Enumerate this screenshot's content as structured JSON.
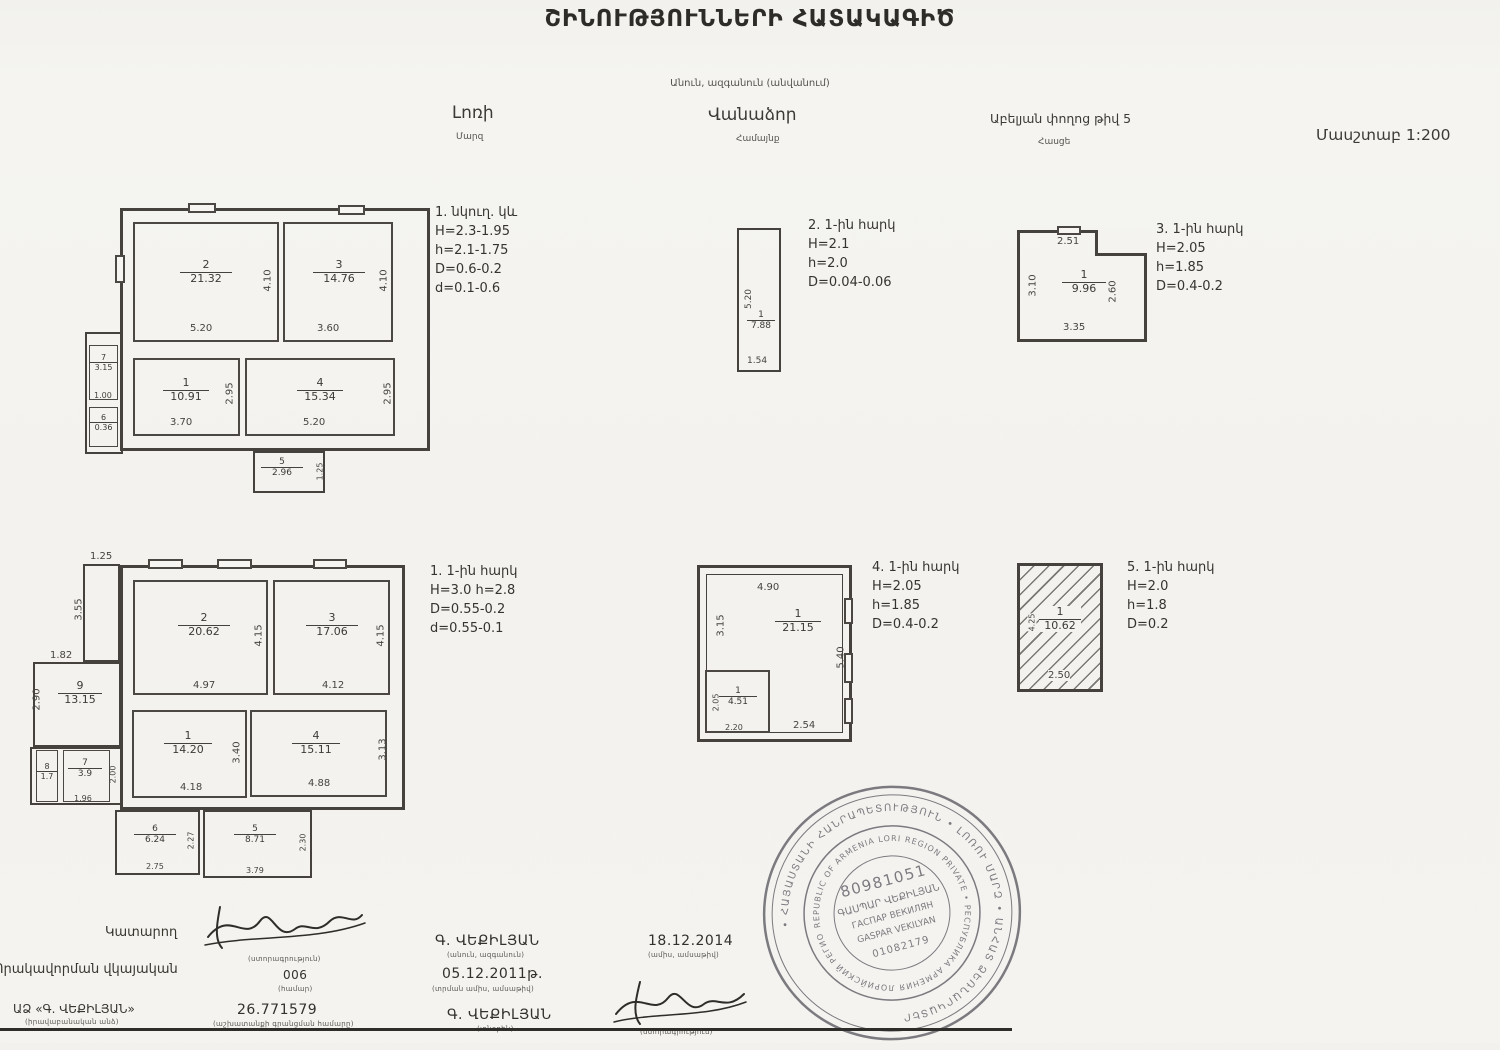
{
  "title": "ՇԻՆՈՒԹՅՈՒՆՆԵՐԻ ՀԱՏԱԿԱԳԻԾ",
  "subtitle": "Անուն, ազգանուն (անվանում)",
  "header": {
    "region_value": "Լոռի",
    "region_label": "Մարզ",
    "community_value": "Վանաձոր",
    "community_label": "Համայնք",
    "address_value": "Աբելյան փողոց թիվ 5",
    "address_label": "Հասցե",
    "scale": "Մասշտաբ 1:200"
  },
  "plans": {
    "basement": {
      "note": [
        "1. նկուղ. կև",
        "H=2.3-1.95",
        "h=2.1-1.75",
        "D=0.6-0.2",
        "d=0.1-0.6"
      ],
      "rooms": {
        "r1": {
          "num": "1",
          "area": "10.91",
          "w": "3.70",
          "h": "2.95"
        },
        "r2": {
          "num": "2",
          "area": "21.32",
          "w": "5.20",
          "h": "4.10"
        },
        "r3": {
          "num": "3",
          "area": "14.76",
          "w": "3.60",
          "h": "4.10"
        },
        "r4": {
          "num": "4",
          "area": "15.34",
          "w": "5.20",
          "h": "2.95"
        },
        "r5": {
          "num": "5",
          "area": "2.96",
          "h": "1.25"
        },
        "r6": {
          "num": "6",
          "area": "0.36"
        },
        "r7": {
          "num": "7",
          "area": "3.15",
          "w": "1.00"
        }
      }
    },
    "wing2": {
      "note": [
        "2. 1-ին հարկ",
        "H=2.1",
        "h=2.0",
        "D=0.04-0.06"
      ],
      "rooms": {
        "r1": {
          "num": "1",
          "area": "7.88",
          "w": "1.54",
          "h": "5.20"
        }
      }
    },
    "wing3": {
      "note": [
        "3. 1-ին հարկ",
        "H=2.05",
        "h=1.85",
        "D=0.4-0.2"
      ],
      "rooms": {
        "r1": {
          "num": "1",
          "area": "9.96",
          "top": "2.51",
          "left": "3.10",
          "right": "2.60",
          "bottom": "3.35"
        }
      }
    },
    "floor1": {
      "note": [
        "1. 1-ին հարկ",
        "H=3.0 h=2.8",
        "D=0.55-0.2",
        "d=0.55-0.1"
      ],
      "dims": {
        "top": "1.25",
        "left": "3.55",
        "annex_top": "1.82",
        "annex_left": "2.90"
      },
      "rooms": {
        "r1": {
          "num": "1",
          "area": "14.20",
          "w": "4.18",
          "h": "3.40"
        },
        "r2": {
          "num": "2",
          "area": "20.62",
          "w": "4.97",
          "h": "4.15"
        },
        "r3": {
          "num": "3",
          "area": "17.06",
          "w": "4.12",
          "h": "4.15"
        },
        "r4": {
          "num": "4",
          "area": "15.11",
          "w": "4.88",
          "h": "3.13"
        },
        "r5": {
          "num": "5",
          "area": "8.71",
          "w": "3.79",
          "h": "2.30"
        },
        "r6": {
          "num": "6",
          "area": "6.24",
          "w": "2.75",
          "h": "2.27"
        },
        "r7": {
          "num": "7",
          "area": "3.9",
          "w": "1.96",
          "h": "2.00"
        },
        "r8": {
          "num": "8",
          "area": "1.7"
        },
        "r9": {
          "num": "9",
          "area": "13.15"
        }
      }
    },
    "wing4": {
      "note": [
        "4. 1-ին հարկ",
        "H=2.05",
        "h=1.85",
        "D=0.4-0.2"
      ],
      "rooms": {
        "r1": {
          "num": "1",
          "area": "21.15",
          "top": "4.90",
          "left": "3.15",
          "right": "5.40",
          "bottom": "2.54"
        },
        "r2": {
          "num": "1",
          "area": "4.51",
          "left": "2.05",
          "bottom": "2.20"
        }
      }
    },
    "wing5": {
      "note": [
        "5. 1-ին հարկ",
        "H=2.0",
        "h=1.8",
        "D=0.2"
      ],
      "rooms": {
        "r1": {
          "num": "1",
          "area": "10.62",
          "left": "4.25",
          "bottom": "2.50"
        }
      }
    }
  },
  "signatures": {
    "executor_label": "Կատարող",
    "sig1_caption": "(ստորագրություն)",
    "qualification_label": "Որակավորման վկայական",
    "cert_number": "006",
    "cert_caption": "(համար)",
    "company": "ԱՁ «Գ. ՎԵՔԻԼՅԱՆ»",
    "company_caption": "(իրավաբանական անձ)",
    "reg_number": "26.771579",
    "reg_caption": "(աշխատանքի գրանցման համարը)",
    "name1": "Գ. ՎԵՔԻԼՅԱՆ",
    "name1_caption": "(անուն, ազգանուն)",
    "date1": "05.12.2011թ.",
    "date1_caption": "(տրման ամիս, ամսաթիվ)",
    "name2": "Գ. ՎԵՔԻԼՅԱՆ",
    "name2_caption": "(տնօրեն)",
    "date2": "18.12.2014",
    "date2_caption": "(ամիս, ամսաթիվ)",
    "sig2_caption": "(ստորագրություն)"
  },
  "stamp": {
    "ring_hy": "• ՀԱՅԱՍՏԱՆԻ ՀԱՆՐԱՊԵՏՈՒԹՅՈՒՆ • ԼՈՌՈՒ ՄԱՐԶ • ԱՆՀԱՏ ՁԵՌՆԱՐԿԱՏԵՐ",
    "ring_en": "REPUBLIC OF ARMENIA LORI REGION PRIVATE • РЕСПУБЛИКА АРМЕНИЯ ЛОРИЙСКИЙ РЕГИОН",
    "number": "80981051",
    "name_hy": "ԳԱՍՊԱՐ ՎԵՔԻԼՅԱՆ",
    "name_ru": "ГАСПАР ВЕКИЛЯН",
    "name_en": "GASPAR VEKILYAN",
    "code": "01082179"
  }
}
